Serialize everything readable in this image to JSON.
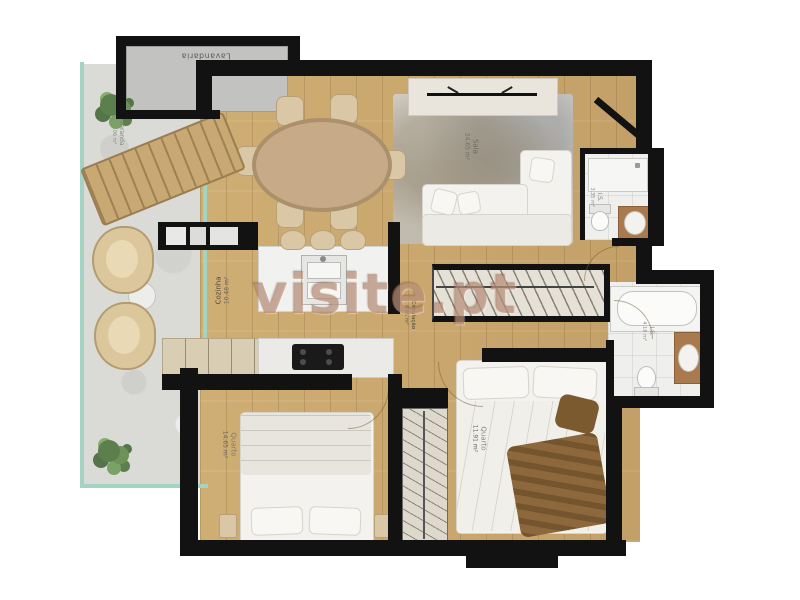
{
  "app": {
    "type": "apartment-floor-plan",
    "watermark": "visite.pt"
  },
  "rooms": {
    "lavandaria": {
      "label": "Lavandaria"
    },
    "varanda": {
      "label": "Varanda",
      "area": "28.06 m²"
    },
    "sala": {
      "label": "Sala",
      "area": "24.65 m²"
    },
    "cozinha": {
      "label": "Cozinha",
      "area": "10.48 m²"
    },
    "circulacao": {
      "label": "Circulação",
      "area": "6.65 m²"
    },
    "is_1": {
      "label": "I.S.",
      "area": "3.35 m²"
    },
    "is_2": {
      "label": "I.S.",
      "area": "4.18 m²"
    },
    "quarto_1": {
      "label": "Quarto",
      "area": "14.65 m²"
    },
    "quarto_2": {
      "label": "Quarto",
      "area": "11.91 m²"
    }
  },
  "colors": {
    "wall": "#121212",
    "wood_floor": "#c9a76d",
    "balcony_concrete": "#dadad7",
    "glass_rail": "#a3d4c3",
    "bathroom_tile": "#efefed",
    "vanity_wood": "#a87a4e",
    "watermark": "#a77054",
    "plant_green": "#5d7f4e",
    "sofa_white": "#f3f2ee",
    "rug_grey": "#d7d3c9",
    "dining_table": "#c7ab88",
    "throw_blanket": "#8d683c"
  }
}
